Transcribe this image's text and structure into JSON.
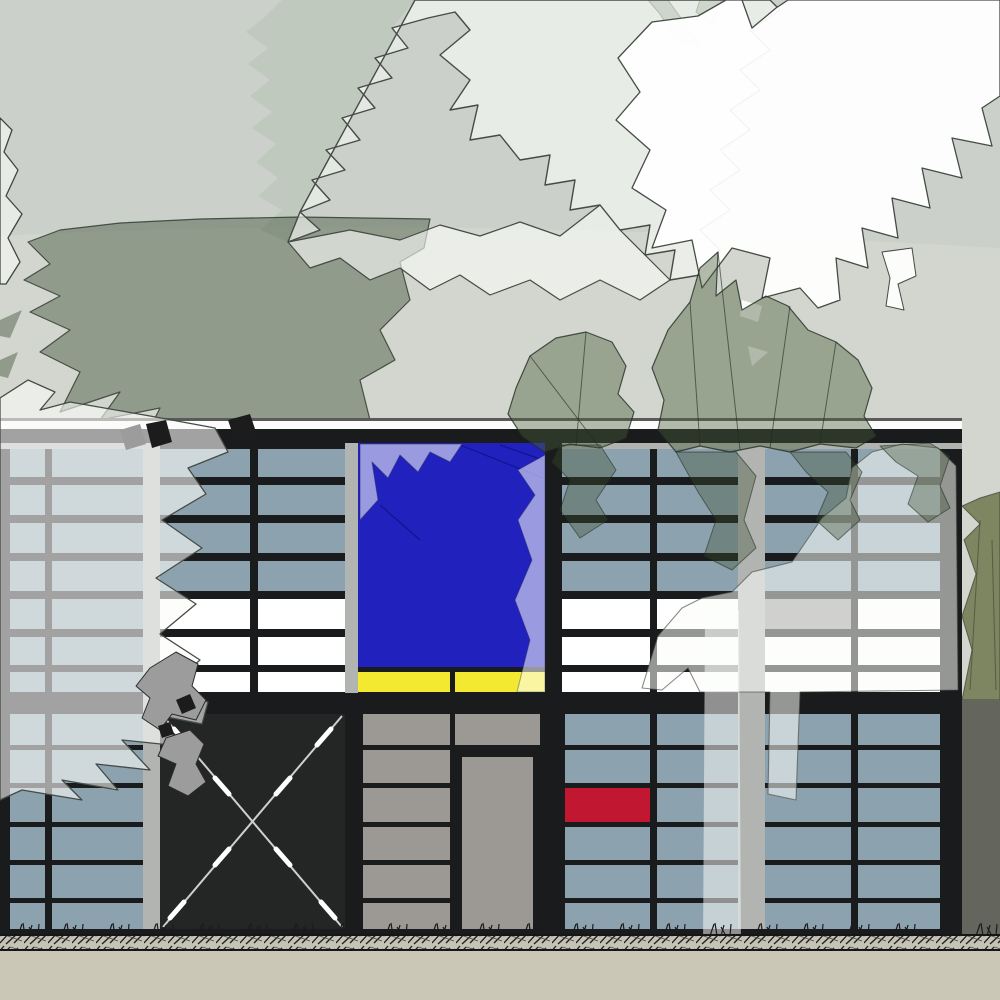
{
  "scene": {
    "title": "eames-style-house-elevation",
    "colors": {
      "sky": "#cbd1ca",
      "hill": "#d2d6ce",
      "canopy_mid": "rgba(185,196,181,0.62)",
      "canopy_dark": "rgba(55,75,50,0.42)",
      "canopy_light": "rgba(252,253,250,0.60)",
      "canopy_white": "rgba(255,255,255,0.94)",
      "canopy_sage": "rgba(75,95,60,0.42)",
      "canopy_sage_tongue": "rgba(60,80,50,0.36)",
      "foliage_outline": "#3f463f",
      "gray_leaf": "#9c9c9c",
      "leaf_black": "#1c1c1c",
      "fascia_line": "#5a5a5a",
      "fascia_white": "#fbfbfb",
      "frame_black": "#191b1c",
      "top_rail_gray": "#b0b3b0",
      "pilaster_gray": "#b2b4b2",
      "glass": "#8da2af",
      "white_panel": "#ffffff",
      "gray_panel": "#9b9b9b",
      "slat_gray": "#9c9893",
      "blue_panel": "#2121bd",
      "blue_facet": "rgba(0,0,90,0.45)",
      "yellow_panel": "#f2e930",
      "red_panel": "#c21731",
      "door_black": "#242626",
      "xbrace_thin": "#cfcfcf",
      "xbrace_dash": "#ffffff",
      "trunk_light": "rgba(252,253,250,0.52)",
      "hedge_olive": "#7d8561",
      "hedge_dark": "#64655d",
      "hatch_bg": "#c5c3b5",
      "hatch_stroke": "#1c1c1c",
      "ground_line": "#161616",
      "soil": "#cac7b6"
    },
    "facade": {
      "left": 0,
      "right": 962,
      "fascia_top_line": [
        418,
        421
      ],
      "fascia_white_band": [
        421,
        429
      ],
      "roof_black_band": [
        429,
        443
      ],
      "top_rail": [
        443,
        449
      ],
      "floor_band": [
        693,
        714
      ],
      "sill": [
        929,
        937
      ],
      "upper_rows": [
        [
          449,
          477
        ],
        [
          485,
          515
        ],
        [
          523,
          553
        ],
        [
          561,
          591
        ],
        [
          599,
          629
        ],
        [
          637,
          665
        ],
        [
          672,
          692
        ]
      ],
      "lower_rows": [
        [
          714,
          745
        ],
        [
          750,
          783
        ],
        [
          788,
          822
        ],
        [
          827,
          860
        ],
        [
          865,
          898
        ],
        [
          903,
          929
        ]
      ],
      "upper_cols": [
        {
          "x": [
            10,
            45
          ],
          "rows": [
            "glass",
            "glass",
            "glass",
            "glass",
            "glass",
            "glass",
            "glass"
          ]
        },
        {
          "x": [
            52,
            143
          ],
          "rows": [
            "glass",
            "glass",
            "glass",
            "glass",
            "glass",
            "glass",
            "glass"
          ]
        },
        {
          "x": [
            160,
            250
          ],
          "rows": [
            "glass",
            "glass",
            "glass",
            "glass",
            "white",
            "white",
            "white"
          ]
        },
        {
          "x": [
            258,
            345
          ],
          "rows": [
            "glass",
            "glass",
            "glass",
            "glass",
            "white",
            "white",
            "white"
          ]
        },
        {
          "x": [
            562,
            650
          ],
          "rows": [
            "glass",
            "glass",
            "glass",
            "glass",
            "white",
            "white",
            "white"
          ]
        },
        {
          "x": [
            657,
            738
          ],
          "rows": [
            "glass",
            "glass",
            "glass",
            "glass",
            "white",
            "white",
            "white"
          ]
        },
        {
          "x": [
            765,
            851
          ],
          "rows": [
            "glass",
            "glass",
            "glass",
            "glass",
            "gray",
            "white",
            "white"
          ]
        },
        {
          "x": [
            858,
            940
          ],
          "rows": [
            "glass",
            "glass",
            "glass",
            "glass",
            "white",
            "white",
            "white"
          ]
        }
      ],
      "lower_cols": [
        {
          "x": [
            10,
            45
          ],
          "rows": [
            "glass",
            "glass",
            "glass",
            "glass",
            "glass",
            "glass"
          ]
        },
        {
          "x": [
            52,
            143
          ],
          "rows": [
            "glass",
            "glass",
            "glass",
            "glass",
            "glass",
            "glass"
          ]
        },
        {
          "x": [
            363,
            450
          ],
          "rows": [
            "slat",
            "slat",
            "slat",
            "slat",
            "slat",
            "slat"
          ]
        },
        {
          "x": [
            565,
            650
          ],
          "rows": [
            "glass",
            "glass",
            "red",
            "glass",
            "glass",
            "glass"
          ]
        },
        {
          "x": [
            657,
            738
          ],
          "rows": [
            "glass",
            "glass",
            "glass",
            "glass",
            "glass",
            "glass"
          ]
        },
        {
          "x": [
            765,
            851
          ],
          "rows": [
            "glass",
            "glass",
            "glass",
            "glass",
            "glass",
            "glass"
          ]
        },
        {
          "x": [
            858,
            940
          ],
          "rows": [
            "glass",
            "glass",
            "glass",
            "glass",
            "glass",
            "glass"
          ]
        }
      ],
      "pilasters": [
        [
          143,
          160,
          443,
          935
        ],
        [
          738,
          765,
          443,
          935
        ],
        [
          345,
          358,
          443,
          693
        ]
      ],
      "blue_panel": {
        "x": [
          358,
          545
        ],
        "y": [
          443,
          667
        ]
      },
      "yellow_strips": [
        [
          358,
          450
        ],
        [
          455,
          545
        ]
      ],
      "yellow_y": [
        672,
        692
      ],
      "red_inset": {
        "x": [
          568,
          648
        ],
        "y": [
          790,
          820
        ]
      },
      "x_door": {
        "x": [
          160,
          345
        ],
        "y": [
          714,
          931
        ]
      },
      "tall_door": {
        "x": [
          462,
          533
        ],
        "y": [
          757,
          929
        ]
      },
      "door_head_panel": {
        "x": [
          455,
          540
        ],
        "y": [
          714,
          745
        ]
      }
    },
    "ground": {
      "hatch_band": [
        936,
        951
      ],
      "soil_band": [
        951,
        1000
      ],
      "grass_x": [
        18,
        62,
        108,
        152,
        198,
        246,
        292,
        338,
        386,
        432,
        478,
        524,
        572,
        618,
        664,
        710,
        756,
        802,
        848,
        894,
        938,
        976
      ]
    }
  }
}
